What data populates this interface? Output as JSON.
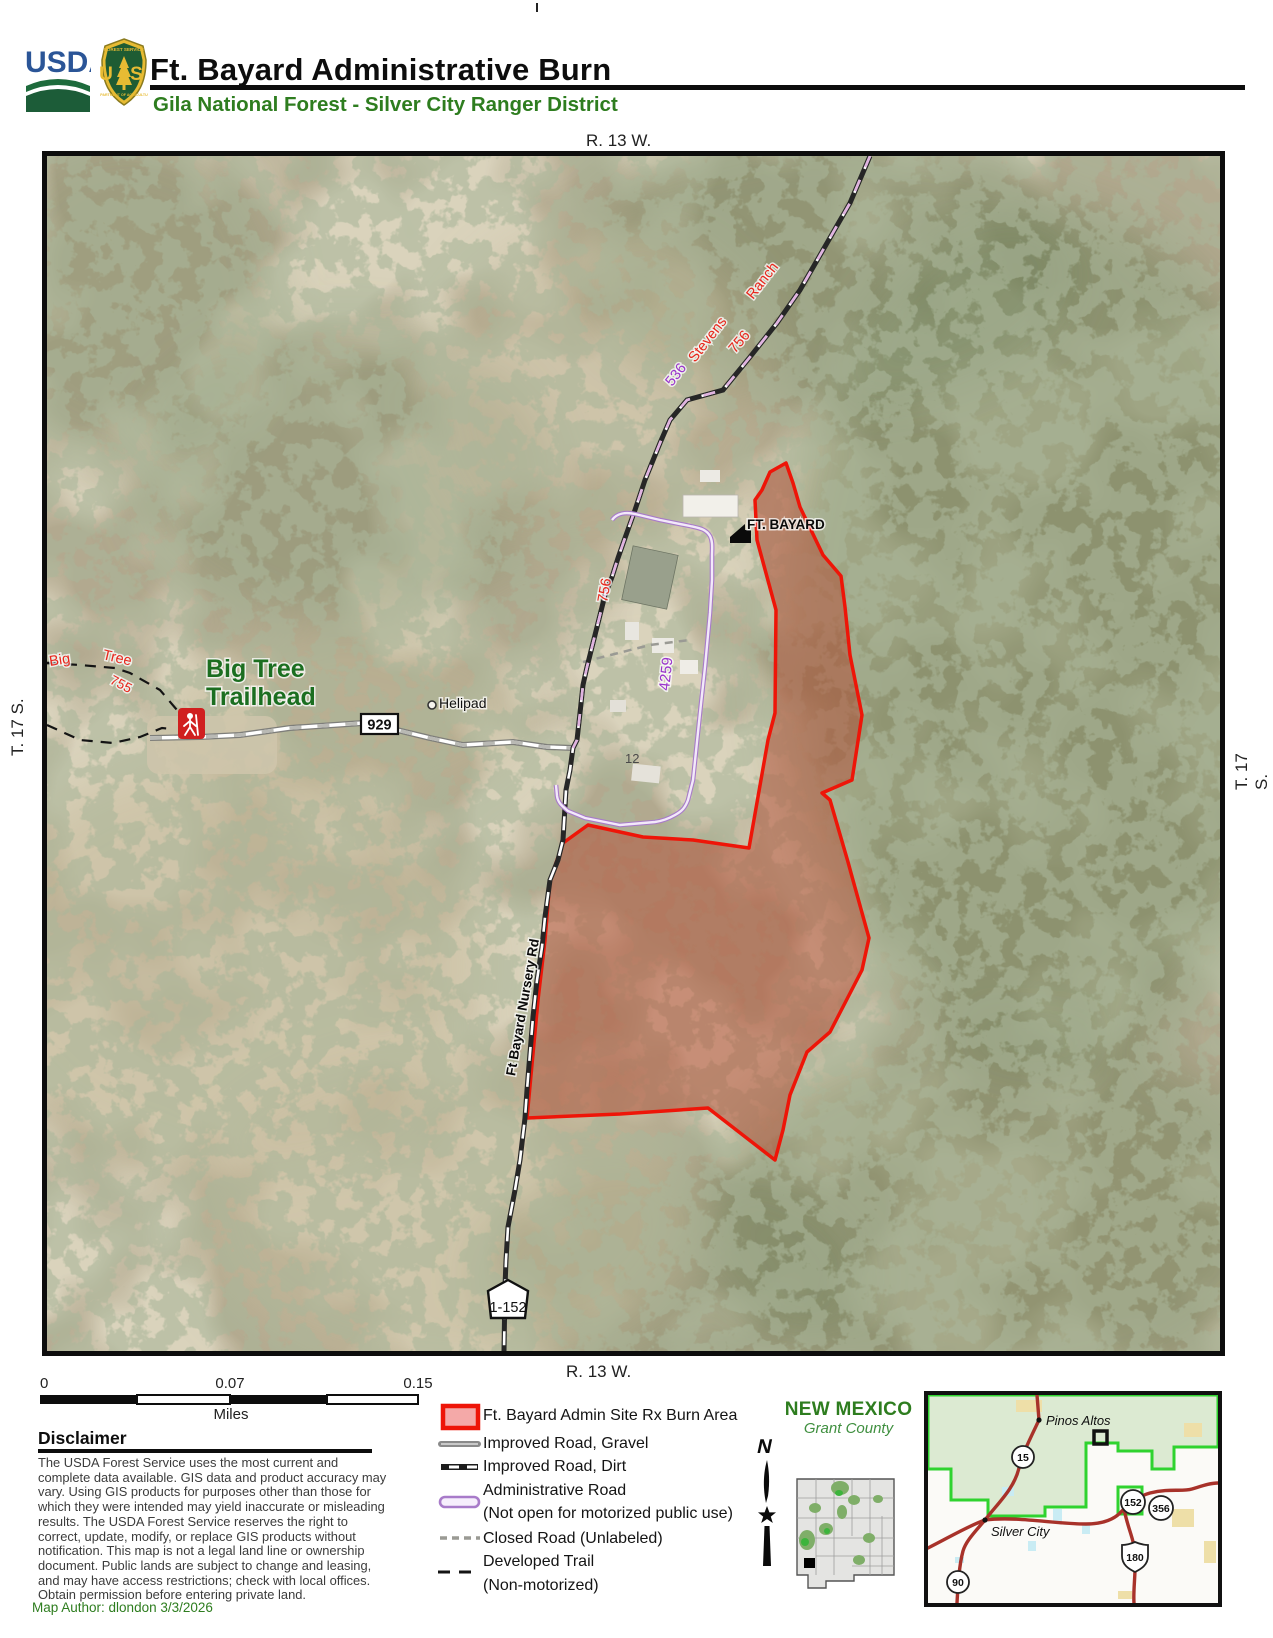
{
  "header": {
    "usda_logotype": "USDA",
    "shield_top": "FOREST SERVICE",
    "shield_letters": "U S",
    "shield_bottom": "DEPARTMENT OF AGRICULTURE",
    "title": "Ft. Bayard Administrative Burn",
    "subtitle": "Gila National Forest - Silver City Ranger District"
  },
  "grid": {
    "top": "R. 13 W.",
    "bottom": "R. 13 W.",
    "left": "T. 17 S.",
    "right": "T. 17 S."
  },
  "map": {
    "labels": {
      "ft_bayard": "FT. BAYARD",
      "helipad": "Helipad",
      "trailhead_line1": "Big Tree",
      "trailhead_line2": "Trailhead",
      "trail_word1": "Big",
      "trail_word2": "Tree",
      "trail_number": "755",
      "route_929": "929",
      "route_536": "536",
      "stevens": "Stevens",
      "ranch": "Ranch",
      "route_756_upper": "756",
      "route_756_lower": "756",
      "route_4259": "4259",
      "nursery_road": "Ft  Bayard  Nursery  Rd",
      "route_1_152": "1-152",
      "building_12": "12"
    }
  },
  "scale_bar": {
    "tick0": "0",
    "tick1": "0.07",
    "tick2": "0.15",
    "units": "Miles"
  },
  "disclaimer": {
    "heading": "Disclaimer",
    "body": "The USDA Forest Service uses the most current and complete data available. GIS data and product accuracy may vary. Using GIS products for purposes other than those for which they were intended may yield inaccurate or misleading results. The USDA Forest Service reserves the right to correct, update, modify, or replace GIS products without notification. This map is not a legal land line or ownership document.  Public lands are subject to change and leasing, and may have access restrictions; check with local offices. Obtain permission before entering private land."
  },
  "author": "Map Author: dlondon 3/3/2026",
  "legend": {
    "burn": "Ft. Bayard Admin Site Rx Burn Area",
    "gravel": "Improved Road, Gravel",
    "dirt": "Improved Road, Dirt",
    "admin": "Administrative Road",
    "admin_note": "(Not open for motorized public use)",
    "closed": "Closed Road (Unlabeled)",
    "trail": "Developed Trail",
    "trail_note": "(Non-motorized)"
  },
  "locator": {
    "state": "NEW MEXICO",
    "county": "Grant County",
    "north": "N"
  },
  "inset": {
    "town1": "Pinos Altos",
    "town2": "Silver City",
    "s15": "15",
    "s152": "152",
    "s356": "356",
    "s180": "180",
    "s90": "90"
  },
  "colors": {
    "burn_outline": "#ee1508",
    "burn_fill": "#f4a9a8",
    "admin_road_purple": "#a87bc9",
    "header_green": "#2e7d1f",
    "usda_blue": "#2b5597",
    "label_red": "#e8261c",
    "label_purple": "#9933cc",
    "trailhead_green": "#1b6e20"
  }
}
